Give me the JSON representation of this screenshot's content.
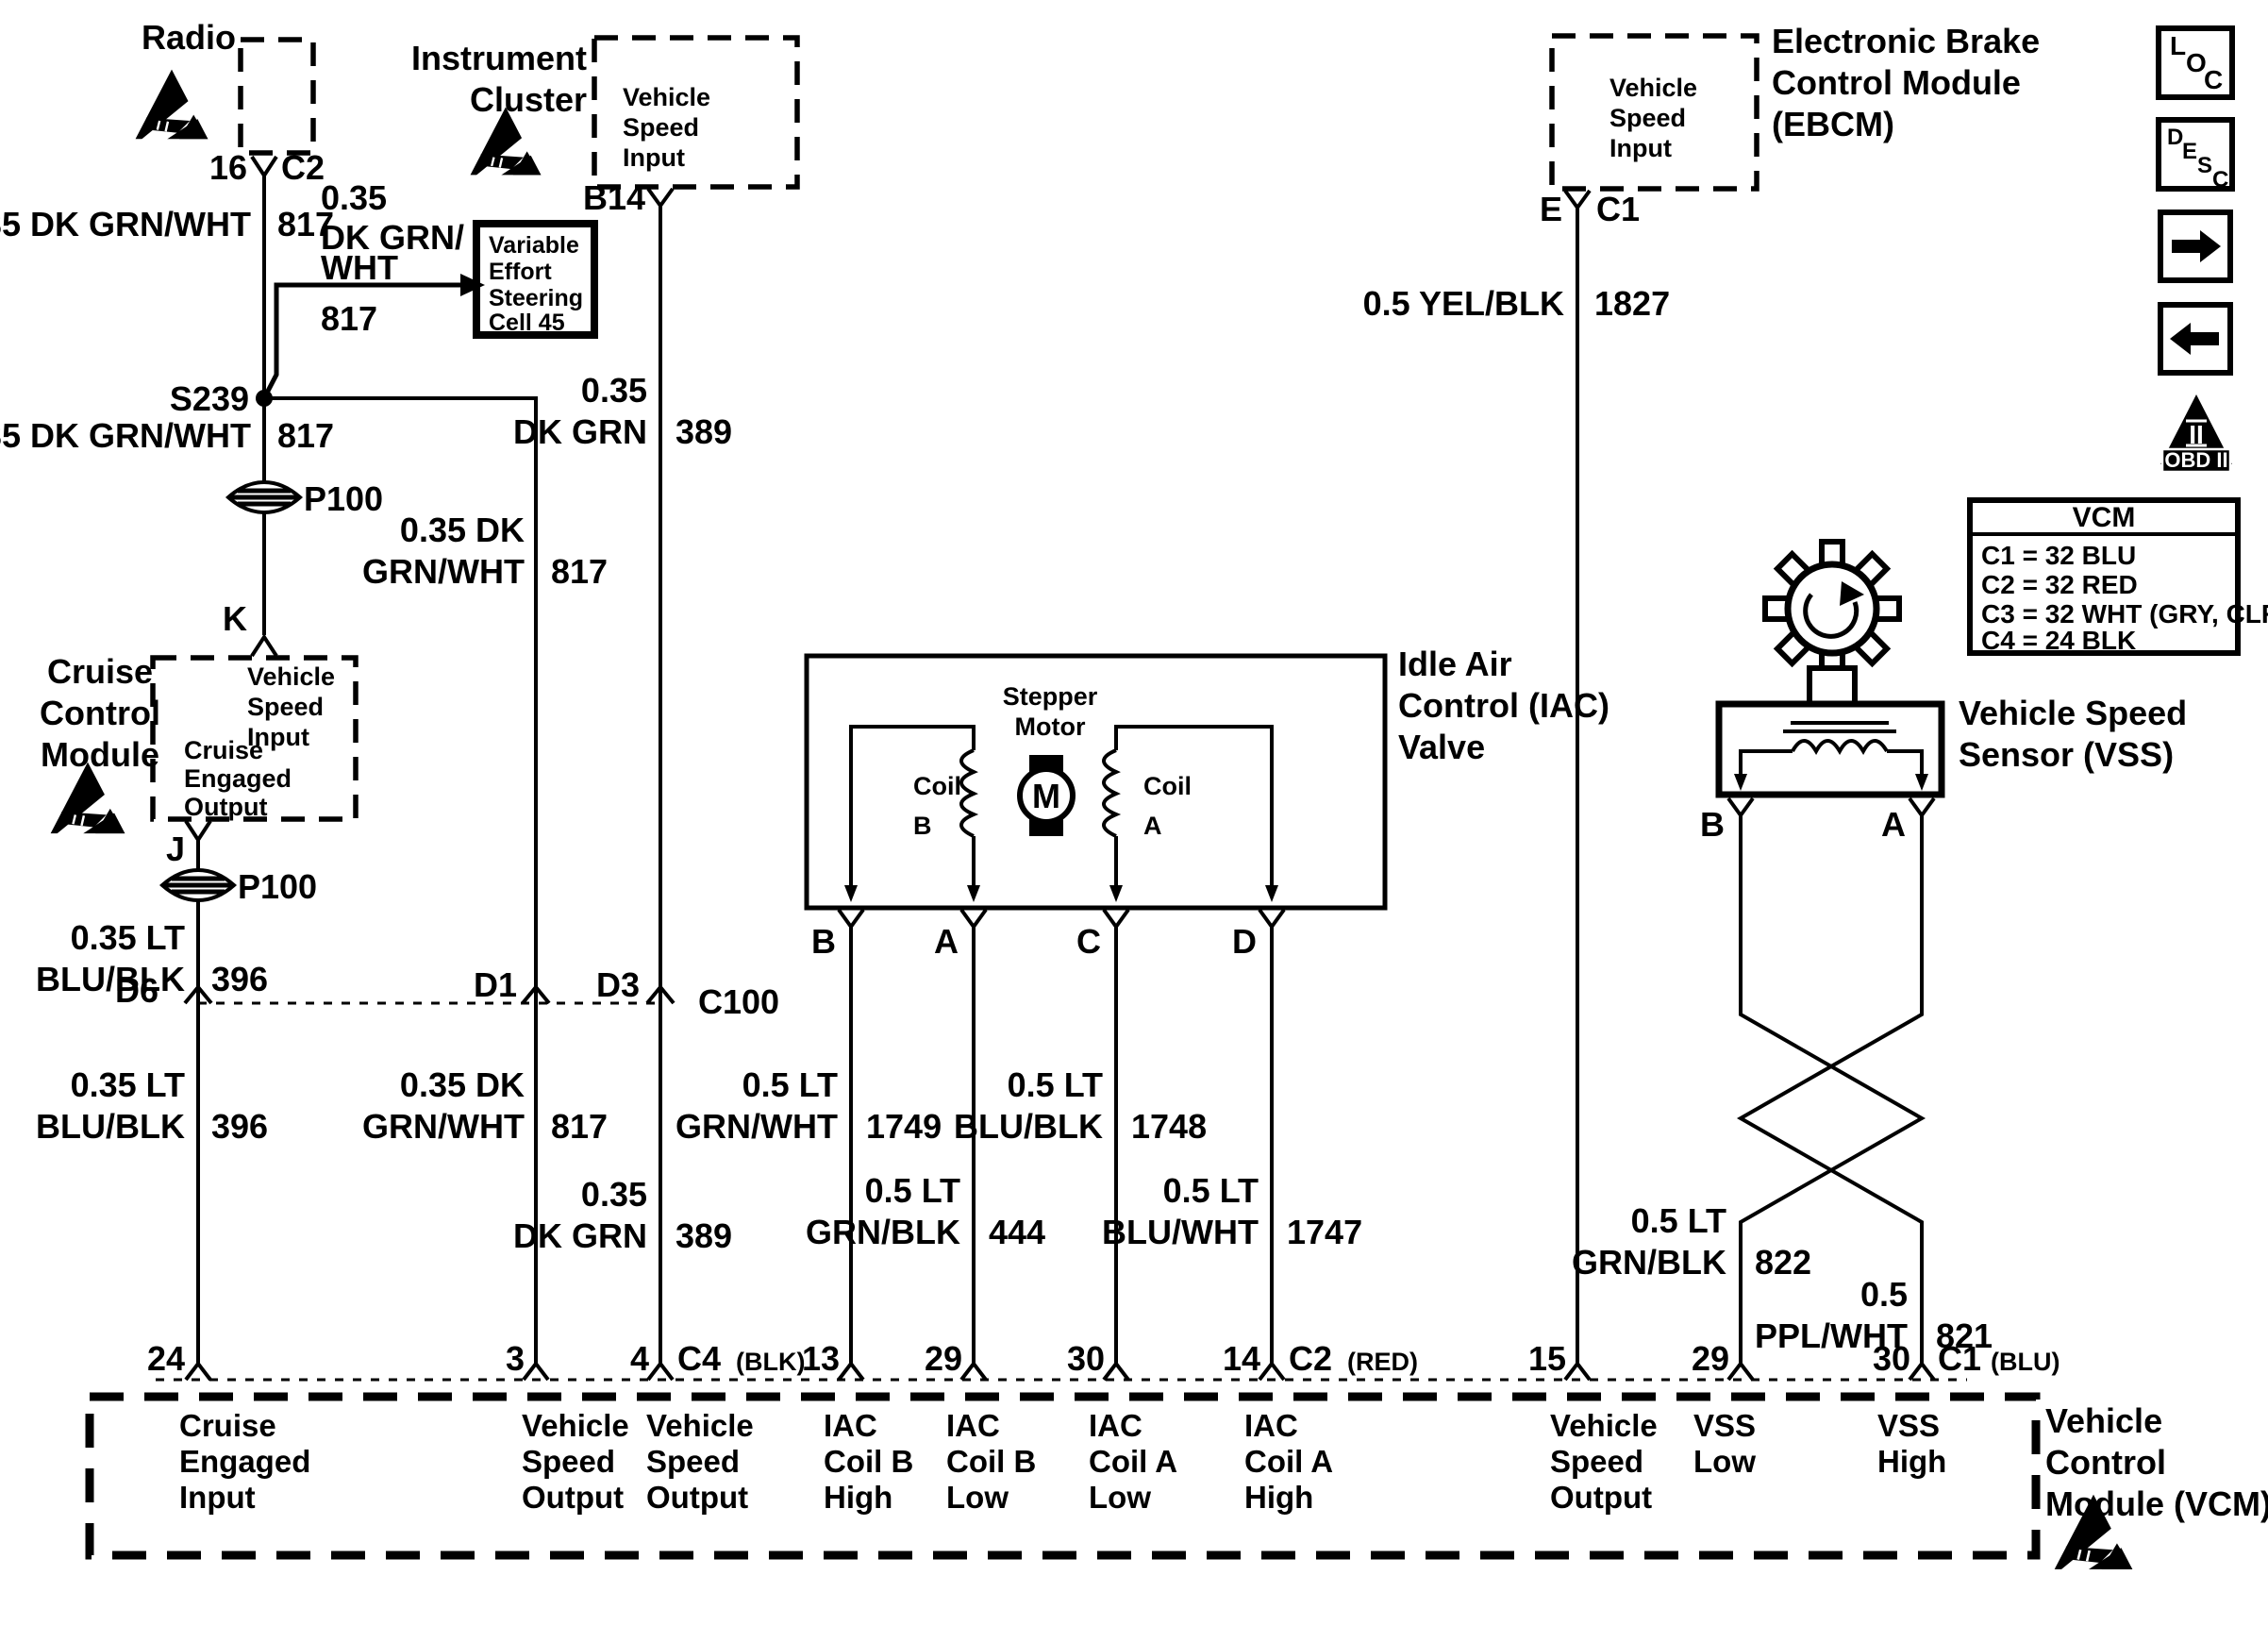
{
  "diagram": {
    "background": "#ffffff",
    "ink": "#000000"
  },
  "nav_icons": {
    "loc": [
      "L",
      "O",
      "C"
    ],
    "desc": [
      "D",
      "E",
      "S",
      "C"
    ],
    "obd": {
      "numeral": "II",
      "label": "OBD II"
    }
  },
  "radio": {
    "title": "Radio",
    "pin": "16",
    "connector": "C2"
  },
  "instrument_cluster": {
    "title": [
      "Instrument",
      "Cluster"
    ],
    "port": [
      "Vehicle",
      "Speed",
      "Input"
    ],
    "pin": "B14"
  },
  "ebcm": {
    "title": [
      "Electronic Brake",
      "Control Module",
      "(EBCM)"
    ],
    "port": [
      "Vehicle",
      "Speed",
      "Input"
    ],
    "pin": "E",
    "connector": "C1"
  },
  "cruise_control_module": {
    "title": [
      "Cruise",
      "Control",
      "Module"
    ],
    "port_in": [
      "Vehicle",
      "Speed",
      "Input"
    ],
    "port_out": [
      "Cruise",
      "Engaged",
      "Output"
    ],
    "pin_in": "K",
    "pin_out": "J"
  },
  "ves_cell": {
    "lines": [
      "Variable",
      "Effort",
      "Steering",
      "Cell 45"
    ]
  },
  "splices": {
    "s239": "S239"
  },
  "grommets": {
    "p100_upper": "P100",
    "p100_lower": "P100"
  },
  "inline_connectors": {
    "d6": "D6",
    "d1": "D1",
    "d3": "D3",
    "c100": "C100"
  },
  "iac_valve": {
    "title": [
      "Idle Air",
      "Control (IAC)",
      "Valve"
    ],
    "stepper": [
      "Stepper",
      "Motor"
    ],
    "motor": "M",
    "coil_b": [
      "Coil",
      "B"
    ],
    "coil_a": [
      "Coil",
      "A"
    ],
    "pin_b": "B",
    "pin_a": "A",
    "pin_c": "C",
    "pin_d": "D"
  },
  "vss": {
    "title": [
      "Vehicle Speed",
      "Sensor (VSS)"
    ],
    "pin_b": "B",
    "pin_a": "A"
  },
  "vcm_connector_legend": {
    "title": "VCM",
    "rows": [
      "C1 = 32 BLU",
      "C2 = 32 RED",
      "C3 = 32 WHT (GRY, CLR)",
      "C4 = 24 BLK"
    ]
  },
  "wires": {
    "radio_upper": {
      "spec": "0.35 DK GRN/WHT",
      "circuit": "817"
    },
    "ves_branch": {
      "spec": [
        "0.35",
        "DK GRN/",
        "WHT"
      ],
      "circuit": "817"
    },
    "radio_lower": {
      "spec": "0.35 DK GRN/WHT",
      "circuit": "817"
    },
    "speed_out_upper": {
      "spec": [
        "0.35 DK",
        "GRN/WHT"
      ],
      "circuit": "817"
    },
    "speed_out_lower": {
      "spec": [
        "0.35 DK",
        "GRN/WHT"
      ],
      "circuit": "817"
    },
    "cluster_upper": {
      "spec": [
        "0.35",
        "DK GRN"
      ],
      "circuit": "389"
    },
    "cluster_lower": {
      "spec": [
        "0.35",
        "DK GRN"
      ],
      "circuit": "389"
    },
    "cruise_upper": {
      "spec": [
        "0.35 LT",
        "BLU/BLK"
      ],
      "circuit": "396"
    },
    "cruise_lower": {
      "spec": [
        "0.35 LT",
        "BLU/BLK"
      ],
      "circuit": "396"
    },
    "iac_b": {
      "spec": [
        "0.5 LT",
        "GRN/WHT"
      ],
      "circuit": "1749"
    },
    "iac_a": {
      "spec": [
        "0.5 LT",
        "GRN/BLK"
      ],
      "circuit": "444"
    },
    "iac_c": {
      "spec": [
        "0.5 LT",
        "BLU/BLK"
      ],
      "circuit": "1748"
    },
    "iac_d": {
      "spec": [
        "0.5 LT",
        "BLU/WHT"
      ],
      "circuit": "1747"
    },
    "ebcm": {
      "spec": "0.5 YEL/BLK",
      "circuit": "1827"
    },
    "vss_low": {
      "spec": [
        "0.5 LT",
        "GRN/BLK"
      ],
      "circuit": "822"
    },
    "vss_high": {
      "spec": [
        "0.5",
        "PPL/WHT"
      ],
      "circuit": "821"
    }
  },
  "vcm": {
    "title": [
      "Vehicle",
      "Control",
      "Module (VCM)"
    ],
    "pins": [
      {
        "number": "24",
        "function": [
          "Cruise",
          "Engaged",
          "Input"
        ]
      },
      {
        "number": "3",
        "function": [
          "Vehicle",
          "Speed",
          "Output"
        ]
      },
      {
        "number": "4",
        "connector": "C4",
        "connector_color": "(BLK)",
        "function": [
          "Vehicle",
          "Speed",
          "Output"
        ]
      },
      {
        "number": "13",
        "function": [
          "IAC",
          "Coil B",
          "High"
        ]
      },
      {
        "number": "29",
        "function": [
          "IAC",
          "Coil B",
          "Low"
        ]
      },
      {
        "number": "30",
        "function": [
          "IAC",
          "Coil A",
          "Low"
        ]
      },
      {
        "number": "14",
        "connector": "C2",
        "connector_color": "(RED)",
        "function": [
          "IAC",
          "Coil A",
          "High"
        ]
      },
      {
        "number": "15",
        "function": [
          "Vehicle",
          "Speed",
          "Output"
        ]
      },
      {
        "number": "29",
        "function": [
          "VSS",
          "Low"
        ]
      },
      {
        "number": "30",
        "connector": "C1",
        "connector_color": "(BLU)",
        "function": [
          "VSS",
          "High"
        ]
      }
    ]
  }
}
